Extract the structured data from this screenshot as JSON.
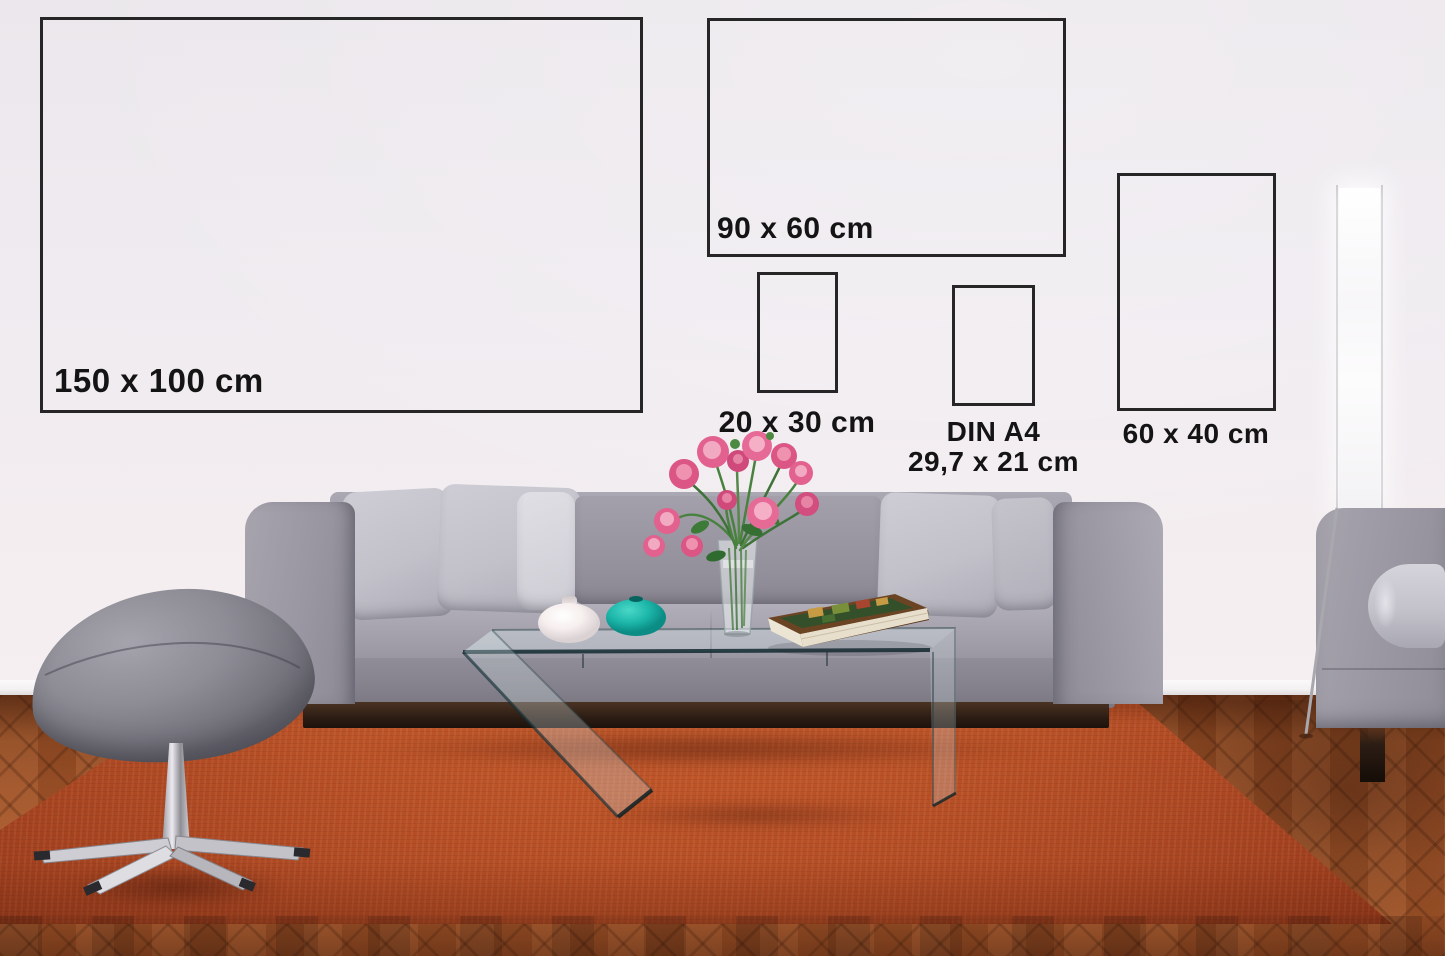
{
  "scene": {
    "type": "living-room poster size mockup photo",
    "room": "living room with gray sofa, glass coffee table, pink flower bouquet, orange rug, herringbone parquet floor, gray footstool, floor lamp and second gray sofa"
  },
  "frames": [
    {
      "id": "size-150x100",
      "label": "150 x 100 cm"
    },
    {
      "id": "size-90x60",
      "label": "90 x 60 cm"
    },
    {
      "id": "size-20x30",
      "label": "20 x 30 cm"
    },
    {
      "id": "size-din-a4",
      "label": "DIN A4",
      "sublabel": "29,7 x 21 cm"
    },
    {
      "id": "size-60x40",
      "label": "60 x 40 cm"
    }
  ],
  "colors": {
    "wall": "#efeaee",
    "frame_border": "#262626",
    "label_text": "#141414",
    "sofa_fabric": "#9b99a4",
    "pillow": "#c9c8d0",
    "rug": "#bd5428",
    "parquet": "#9e5228",
    "teal_vase": "#1cb6a9",
    "white_vase": "#f6efee",
    "flowers_pink": "#e0628f",
    "stem_green": "#49823f",
    "chrome": "#cfcfd5",
    "plinth_wood": "#2c1d14"
  }
}
